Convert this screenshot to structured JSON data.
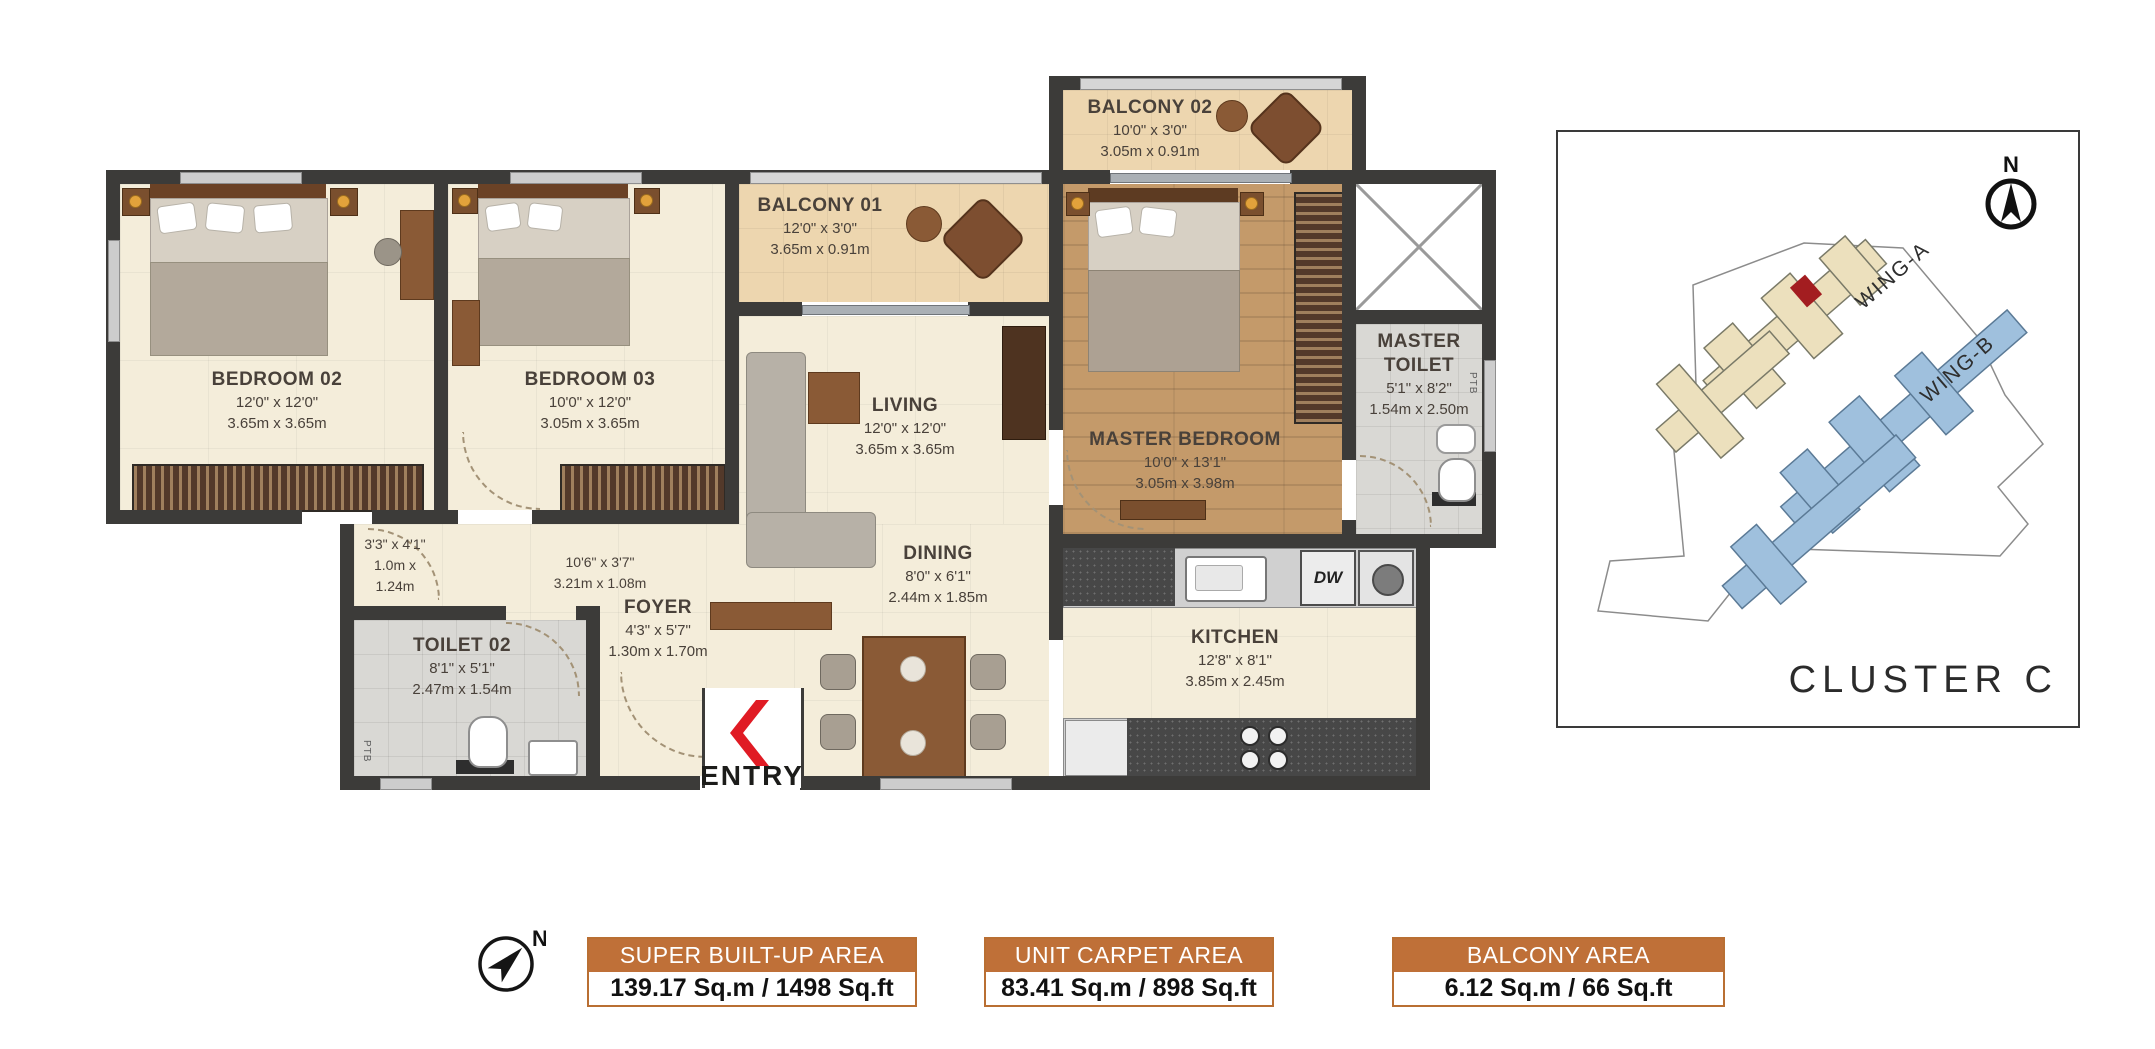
{
  "floor_plan": {
    "rooms": [
      {
        "name": "BALCONY 02",
        "dim_ft": "10'0\" x 3'0\"",
        "dim_m": "3.05m x 0.91m"
      },
      {
        "name": "BALCONY 01",
        "dim_ft": "12'0\" x 3'0\"",
        "dim_m": "3.65m x 0.91m"
      },
      {
        "name": "BEDROOM 02",
        "dim_ft": "12'0\" x 12'0\"",
        "dim_m": "3.65m x 3.65m"
      },
      {
        "name": "BEDROOM 03",
        "dim_ft": "10'0\" x 12'0\"",
        "dim_m": "3.05m x 3.65m"
      },
      {
        "name": "LIVING",
        "dim_ft": "12'0\" x 12'0\"",
        "dim_m": "3.65m x 3.65m"
      },
      {
        "name": "MASTER BEDROOM",
        "dim_ft": "10'0\" x 13'1\"",
        "dim_m": "3.05m x 3.98m"
      },
      {
        "name": "MASTER TOILET",
        "dim_ft": "5'1\" x 8'2\"",
        "dim_m": "1.54m x 2.50m"
      },
      {
        "name": "DINING",
        "dim_ft": "8'0\" x 6'1\"",
        "dim_m": "2.44m x 1.85m"
      },
      {
        "name": "KITCHEN",
        "dim_ft": "12'8\" x 8'1\"",
        "dim_m": "3.85m x 2.45m"
      },
      {
        "name": "FOYER",
        "dim_ft": "4'3\" x 5'7\"",
        "dim_m": "1.30m x 1.70m"
      },
      {
        "name": "TOILET 02",
        "dim_ft": "8'1\" x 5'1\"",
        "dim_m": "2.47m x 1.54m"
      }
    ],
    "passages": [
      {
        "dim_ft": "3'3\" x 4'1\"",
        "dim_m_line1": "1.0m x",
        "dim_m_line2": "1.24m"
      },
      {
        "dim_ft": "10'6\" x 3'7\"",
        "dim_m": "3.21m x 1.08m"
      }
    ],
    "labels": {
      "entry": "ENTRY",
      "dishwasher": "DW",
      "duct": "PTB"
    }
  },
  "cluster_map": {
    "title": "CLUSTER C",
    "wing_a_label": "WING-A",
    "wing_b_label": "WING-B",
    "north_label": "N"
  },
  "area_summary": {
    "north_label": "N",
    "boxes": [
      {
        "title": "SUPER BUILT-UP AREA",
        "value": "139.17 Sq.m / 1498 Sq.ft"
      },
      {
        "title": "UNIT CARPET AREA",
        "value": "83.41 Sq.m / 898 Sq.ft"
      },
      {
        "title": "BALCONY AREA",
        "value": "6.12 Sq.m / 66 Sq.ft"
      }
    ]
  },
  "colors": {
    "wall": "#3c3b39",
    "accent_orange": "#bf7038",
    "entry_red": "#e01b24",
    "wing_a_fill": "#ece0bd",
    "wing_b_fill": "#9fc0dd",
    "highlight_unit_red": "#a31d20"
  }
}
